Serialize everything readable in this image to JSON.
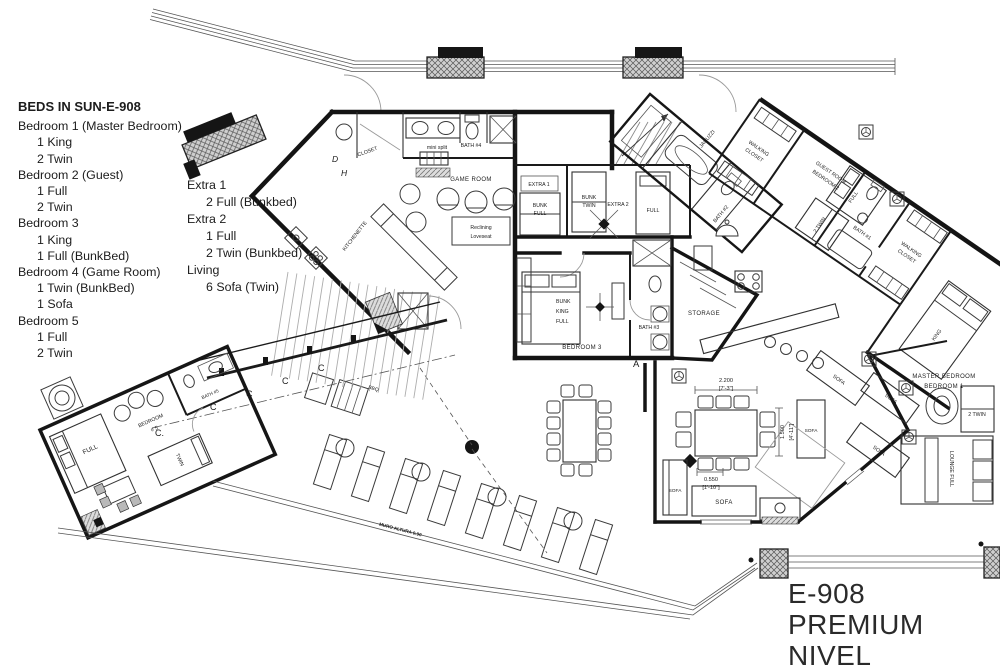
{
  "legend": {
    "title": "BEDS IN SUN-E-908",
    "items": [
      "Bedroom 1 (Master Bedroom)",
      "1 King",
      "2 Twin",
      "Bedroom 2 (Guest)",
      "1 Full",
      "2 Twin",
      "Bedroom 3",
      "1 King",
      "1 Full (BunkBed)",
      "Bedroom 4 (Game Room)",
      "1 Twin (BunkBed)",
      "1 Sofa",
      "Bedroom 5",
      "1 Full",
      "2 Twin"
    ]
  },
  "extras": {
    "items": [
      "Extra 1",
      "2 Full (Bunkbed)",
      "Extra 2",
      "1 Full",
      "2 Twin (Bunkbed)",
      "Living",
      "6 Sofa (Twin)"
    ]
  },
  "title_block": {
    "code": "E-908",
    "level": "PREMIUM NIVEL"
  },
  "plan": {
    "rooms": {
      "game_room": "GAME ROOM",
      "bath4": "BATH #4",
      "closet": "CLOSET",
      "kitchenette": "KITCHENETTE",
      "extra1": "EXTRA 1",
      "extra2": "EXTRA 2",
      "bedroom3": "BEDROOM 3",
      "bath3": "BATH #3",
      "storage": "STORAGE",
      "jacuzzi": "JACUZZI",
      "bath2": "BATH #2",
      "walking": "WALKING",
      "closet2": "CLOSET",
      "guest1": "GUEST ROOM",
      "guest2": "BEDROOM 2",
      "bath1": "BATH #1",
      "master1": "MASTER BEDROOM",
      "master2": "BEDROOM 1",
      "bedroom5a": "BEDROOM",
      "bedroom5b": "# 5",
      "bath5": "BATH #5",
      "lounge": "LOUNGE FULL"
    },
    "furniture": {
      "bunk": "BUNK",
      "full": "FULL",
      "twin": "TWIN",
      "king": "KING",
      "two_twin": "2 TWIN",
      "sofa": "SOFA",
      "recl1": "Reclining",
      "recl2": "Loveseat",
      "mini_split": "mini split",
      "bbq": "BBQ"
    },
    "dims": {
      "w": "2.200",
      "w_ft": "[7'-3\"]",
      "d": "1.500",
      "d_ft": "[4'-11\"]",
      "s": "0.550",
      "s_ft": "[1'-10\"]"
    },
    "markers": {
      "a": "A",
      "c": "C",
      "c_dot": "C.",
      "d": "D",
      "h": "H"
    },
    "notes": {
      "muro": "MURO ALTURA 0.90"
    }
  }
}
